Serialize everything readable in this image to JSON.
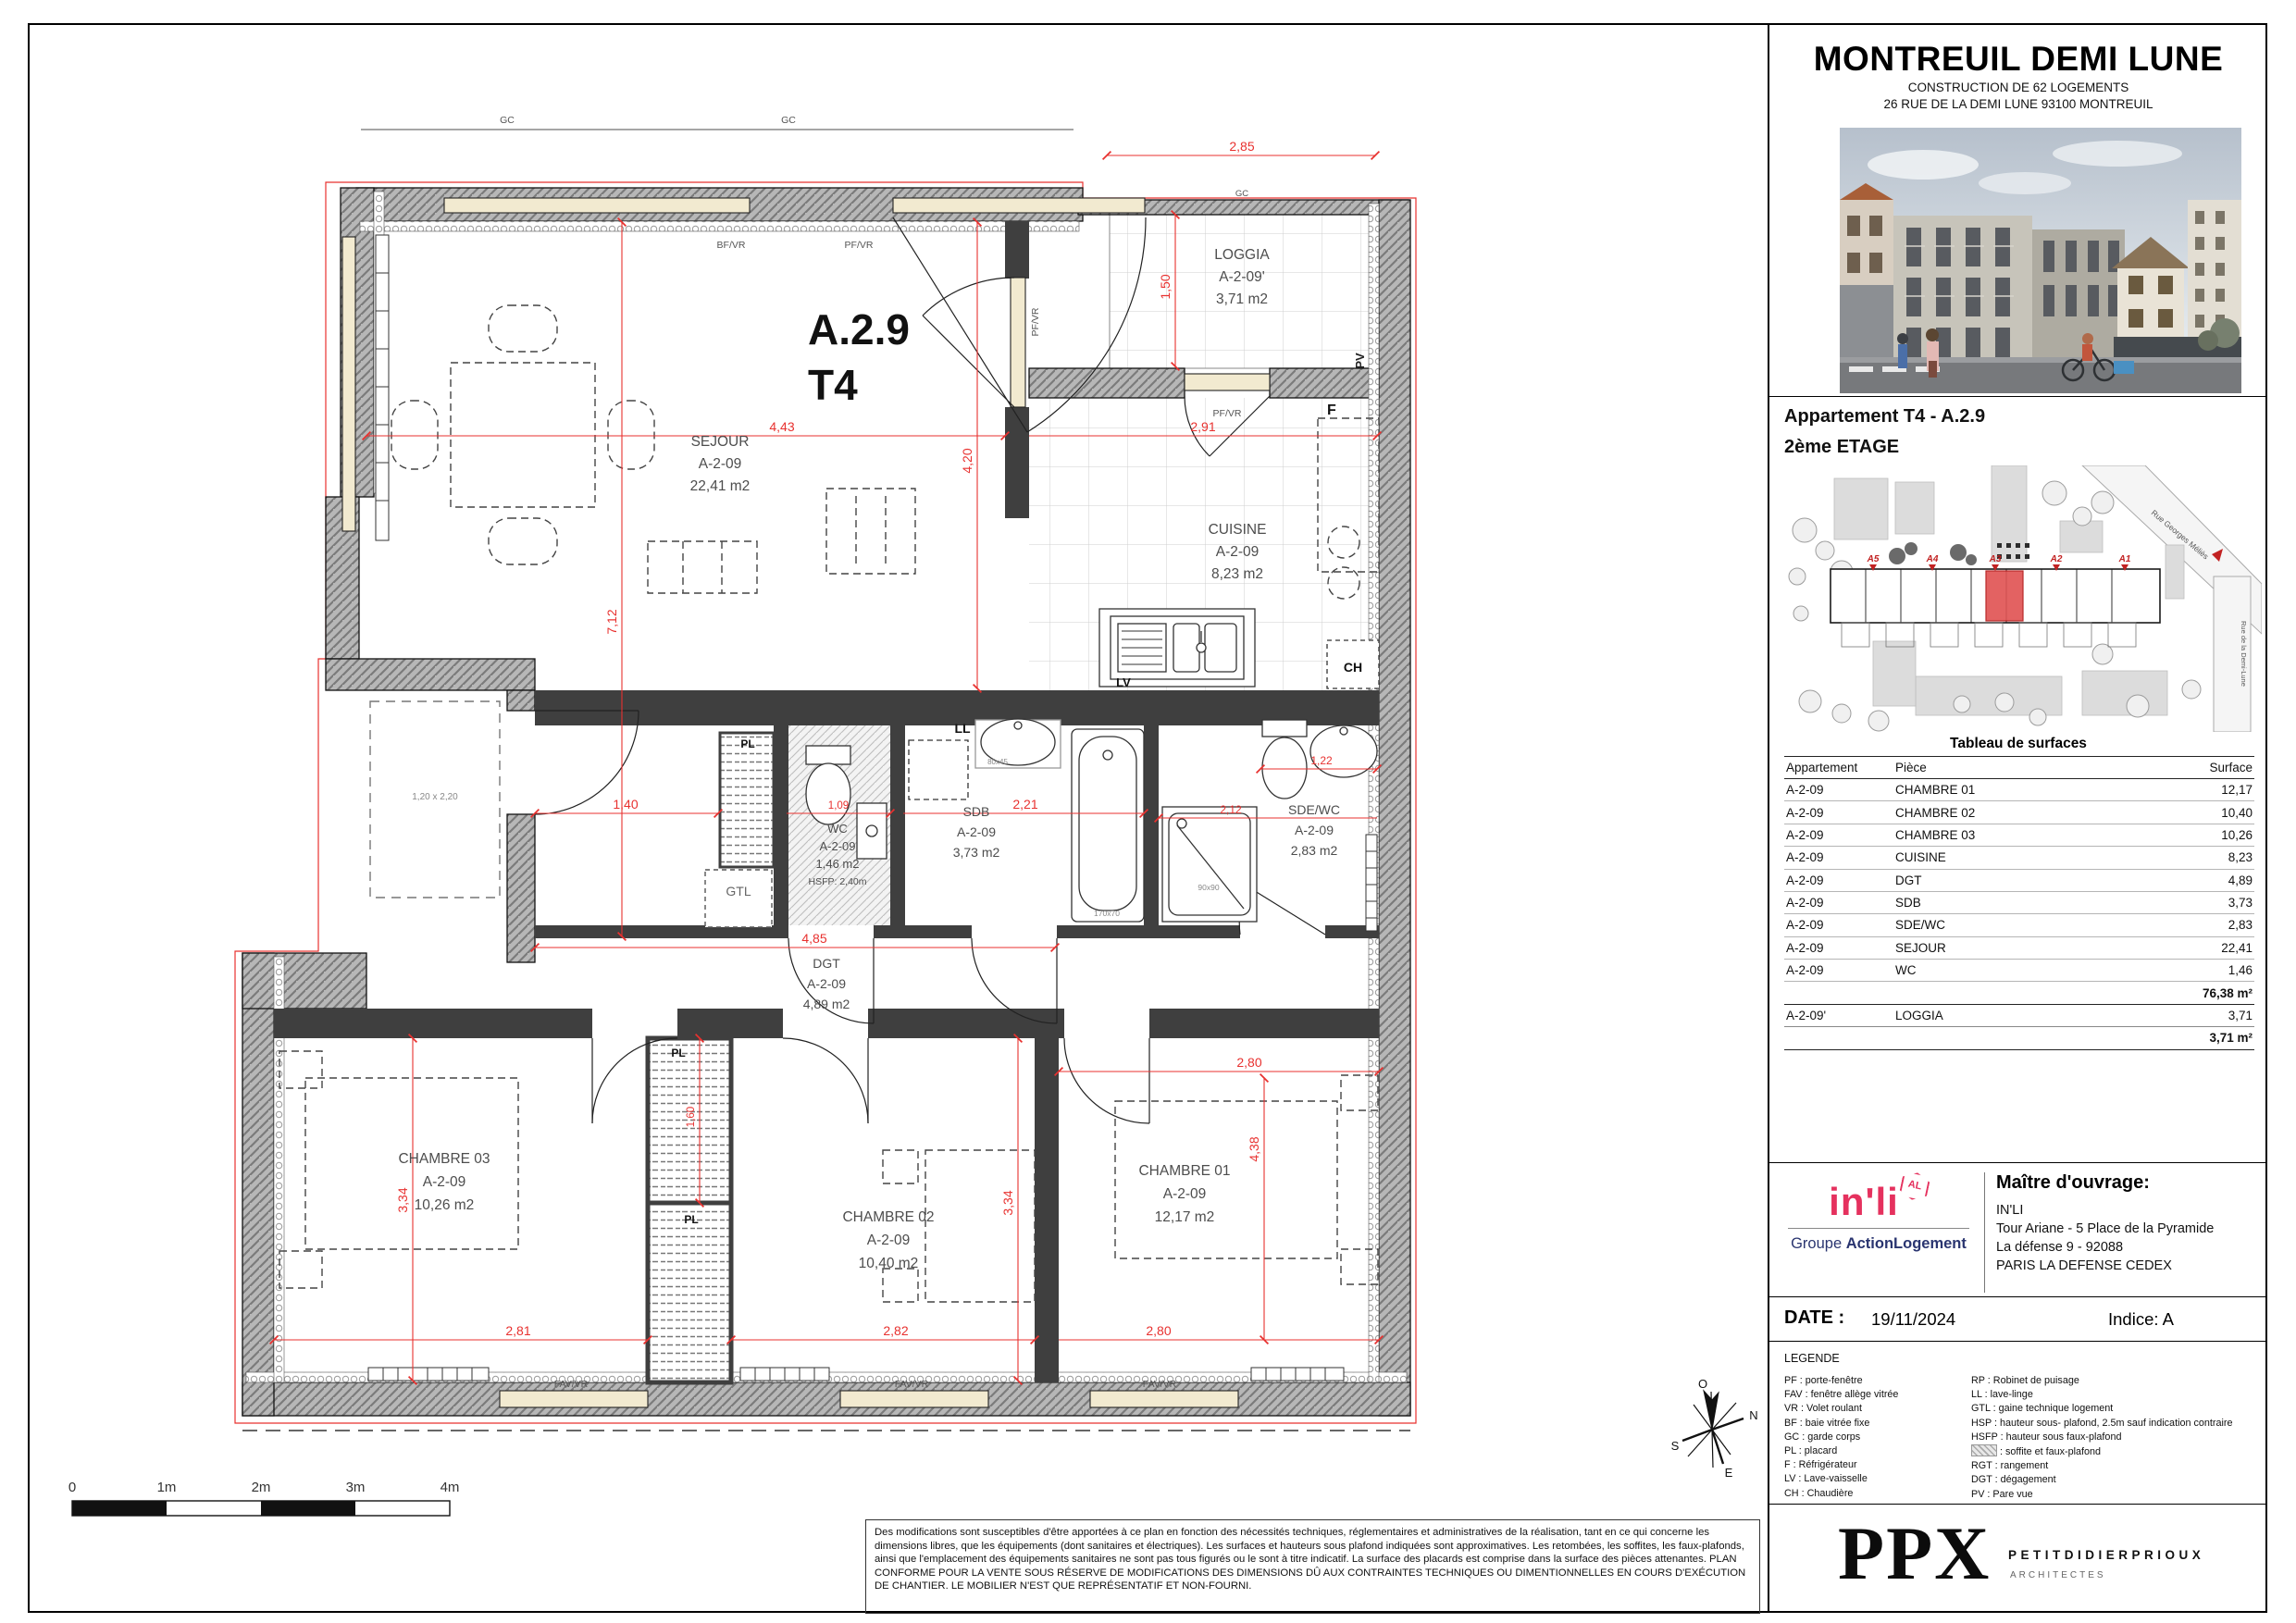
{
  "panel": {
    "title": "MONTREUIL DEMI LUNE",
    "subtitle1": "CONSTRUCTION DE 62 LOGEMENTS",
    "subtitle2": "26 RUE DE LA DEMI LUNE 93100 MONTREUIL",
    "apartment_title": "Appartement T4 - A.2.9",
    "floor": "2ème ETAGE",
    "surface_table": {
      "title": "Tableau de surfaces",
      "columns": [
        "Appartement",
        "Pièce",
        "Surface"
      ],
      "rows": [
        [
          "A-2-09",
          "CHAMBRE 01",
          "12,17"
        ],
        [
          "A-2-09",
          "CHAMBRE 02",
          "10,40"
        ],
        [
          "A-2-09",
          "CHAMBRE 03",
          "10,26"
        ],
        [
          "A-2-09",
          "CUISINE",
          "8,23"
        ],
        [
          "A-2-09",
          "DGT",
          "4,89"
        ],
        [
          "A-2-09",
          "SDB",
          "3,73"
        ],
        [
          "A-2-09",
          "SDE/WC",
          "2,83"
        ],
        [
          "A-2-09",
          "SEJOUR",
          "22,41"
        ],
        [
          "A-2-09",
          "WC",
          "1,46"
        ]
      ],
      "total_main": "76,38 m²",
      "loggia_row": [
        "A-2-09'",
        "LOGGIA",
        "3,71"
      ],
      "total_loggia": "3,71 m²"
    },
    "owner": {
      "heading": "Maître d'ouvrage:",
      "line1": "IN'LI",
      "line2": "Tour Ariane - 5 Place de la Pyramide",
      "line3": "La défense 9 - 92088",
      "line4": "PARIS LA DEFENSE CEDEX",
      "logo_text": "in'li",
      "logo_badge": "AL",
      "logo_sub_regular": "Groupe ",
      "logo_sub_bold": "ActionLogement"
    },
    "date_label": "DATE :",
    "date_value": "19/11/2024",
    "indice": "Indice: A",
    "legend": {
      "heading": "LEGENDE",
      "col1": [
        "PF : porte-fenêtre",
        "FAV : fenêtre allège vitrée",
        "VR : Volet roulant",
        "BF : baie vitrée fixe",
        "GC : garde corps",
        "PL : placard",
        "F : Réfrigérateur",
        "LV : Lave-vaisselle",
        "CH : Chaudière"
      ],
      "col2_before": [
        "RP : Robinet de puisage",
        "LL : lave-linge",
        "GTL : gaine technique logement",
        "HSP : hauteur sous- plafond, 2.5m sauf indication contraire",
        "HSFP : hauteur sous faux-plafond"
      ],
      "swatch_line": ": soffite et faux-plafond",
      "col2_after": [
        "RGT : rangement",
        "DGT : dégagement",
        "PV : Pare vue"
      ]
    },
    "architect": {
      "logo": "PPX",
      "name": "PETITDIDIERPRIOUX",
      "subtitle": "ARCHITECTES"
    },
    "siteplan": {
      "street1": "Rue Georges Méliès",
      "street2": "Rue de la Demi-Lune",
      "buildings": [
        "A5",
        "A4",
        "A3",
        "A2",
        "A1"
      ]
    }
  },
  "plan": {
    "unit": "A.2.9",
    "type": "T4",
    "rooms": {
      "sejour": {
        "name": "SEJOUR",
        "code": "A-2-09",
        "area": "22,41 m2"
      },
      "cuisine": {
        "name": "CUISINE",
        "code": "A-2-09",
        "area": "8,23 m2"
      },
      "loggia": {
        "name": "LOGGIA",
        "code": "A-2-09'",
        "area": "3,71 m2"
      },
      "wc": {
        "name": "WC",
        "code": "A-2-09",
        "area": "1,46 m2",
        "note": "HSFP: 2,40m"
      },
      "sdb": {
        "name": "SDB",
        "code": "A-2-09",
        "area": "3,73 m2"
      },
      "sdewc": {
        "name": "SDE/WC",
        "code": "A-2-09",
        "area": "2,83 m2"
      },
      "dgt": {
        "name": "DGT",
        "code": "A-2-09",
        "area": "4,89 m2"
      },
      "ch1": {
        "name": "CHAMBRE 01",
        "code": "A-2-09",
        "area": "12,17 m2"
      },
      "ch2": {
        "name": "CHAMBRE 02",
        "code": "A-2-09",
        "area": "10,40 m2"
      },
      "ch3": {
        "name": "CHAMBRE 03",
        "code": "A-2-09",
        "area": "10,26 m2"
      }
    },
    "tags": {
      "gc": "GC",
      "bfvr": "BF/VR",
      "pfvr": "PF/VR",
      "favvr": "FAV/VR",
      "pv": "PV",
      "f": "F",
      "ch": "CH",
      "lv": "LV",
      "ll": "LL",
      "gtl": "GTL",
      "pl": "PL",
      "bath_size": "170x70",
      "shower_size": "90x90",
      "basin_size": "80x45",
      "shaft_size": "1,20 x 2,20"
    },
    "dims": {
      "sejour_w": "4,43",
      "sejour_h": "4,20",
      "left_h": "7,12",
      "loggia_w": "2,85",
      "loggia_h": "1,50",
      "cuisine_w": "2,91",
      "hall_w": "1,40",
      "wc_w": "1,09",
      "sdb_w": "2,21",
      "sdewc_w": "1,22",
      "sdewc_w2": "2,12",
      "dgt_w": "4,85",
      "ch3_w": "2,81",
      "ch3_h": "3,34",
      "ch2_w": "2,82",
      "ch2_h": "3,34",
      "ch1_wt": "2,80",
      "ch1_wb": "2,80",
      "ch1_h": "4,38",
      "pl_h": "1,60"
    },
    "compass": {
      "n": "N",
      "s": "S",
      "e": "E",
      "o": "O"
    },
    "scalebar": [
      "0",
      "1m",
      "2m",
      "3m",
      "4m"
    ]
  },
  "disclaimer": "Des modifications sont susceptibles d'être apportées à ce plan en fonction des nécessités techniques, réglementaires et administratives de la réalisation, tant en ce qui concerne les dimensions libres, que les équipements (dont sanitaires et électriques). Les surfaces et hauteurs sous plafond indiquées sont approximatives. Les retombées, les soffites, les faux-plafonds, ainsi que l'emplacement des équipements sanitaires ne sont pas tous figurés ou le sont à titre indicatif. La surface des placards est comprise dans la surface des pièces attenantes. PLAN CONFORME POUR LA VENTE SOUS RÉSERVE DE MODIFICATIONS DES DIMENSIONS DÛ AUX CONTRAINTES TECHNIQUES OU DIMENTIONNELLES EN COURS D'EXÉCUTION DE CHANTIER. LE MOBILIER N'EST QUE REPRÉSENTATIF ET NON-FOURNI."
}
